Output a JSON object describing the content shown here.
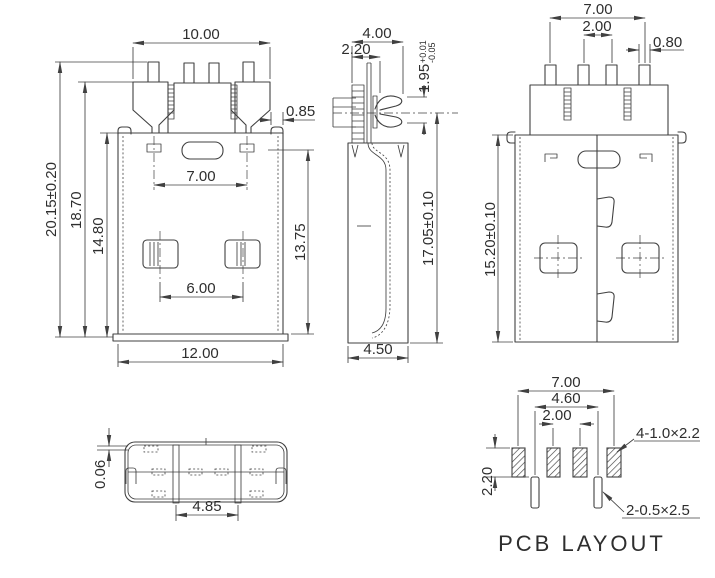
{
  "front_view": {
    "dim_top_width": "10.00",
    "dim_ear_width": "0.85",
    "dim_hole_span": "7.00",
    "dim_dimple_span": "6.00",
    "dim_bottom_width": "12.00",
    "dim_total_height": "20.15±0.20",
    "dim_shell_height": "18.70",
    "dim_body_height": "14.80",
    "dim_right_height": "13.75"
  },
  "side_view": {
    "dim_depth": "4.00",
    "dim_tab_offset": "2.20",
    "dim_contact_height": "1.95",
    "dim_contact_tol_plus": "+0.01",
    "dim_contact_tol_minus": "-0.05",
    "dim_height": "17.05±0.10",
    "dim_bottom_depth": "4.50"
  },
  "back_view": {
    "dim_pin_span": "7.00",
    "dim_pin_pitch": "2.00",
    "dim_pin_width": "0.80",
    "dim_height": "15.20±0.10"
  },
  "top_view": {
    "dim_gap": "0.06",
    "dim_slot_span": "4.85"
  },
  "pcb_layout": {
    "dim_pad_span": "7.00",
    "dim_slot_span": "4.60",
    "dim_pad_pitch": "2.00",
    "dim_pad_height": "2.20",
    "label_pads": "4-1.0×2.2",
    "label_slots": "2-0.5×2.5",
    "title": "PCB LAYOUT"
  }
}
